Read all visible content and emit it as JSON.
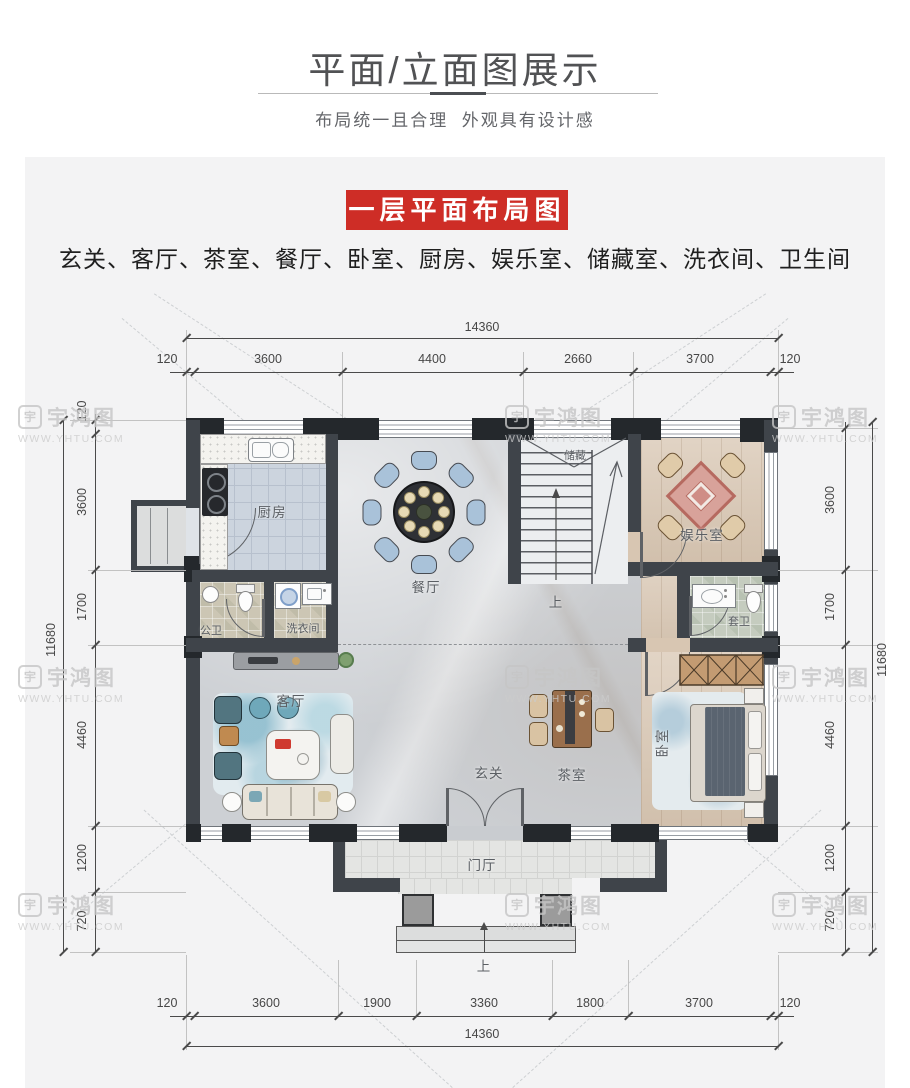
{
  "header": {
    "title": "平面/立面图展示",
    "subtitle": "布局统一且合理  外观具有设计感"
  },
  "section": {
    "badge": "一层平面布局图",
    "room_list": "玄关、客厅、茶室、餐厅、卧室、厨房、娱乐室、储藏室、洗衣间、卫生间"
  },
  "plan": {
    "rooms": {
      "kitchen": "厨房",
      "dining": "餐厅",
      "storage": "储藏",
      "stairs_up": "上",
      "entertainment": "娱乐室",
      "public_bath": "公卫",
      "laundry": "洗衣间",
      "ensuite": "套卫",
      "living": "客厅",
      "foyer": "玄关",
      "tea": "茶室",
      "bedroom": "卧室",
      "porch": "门厅",
      "entry_up": "上"
    },
    "dims": {
      "top_total": "14360",
      "top_segments": [
        "120",
        "3600",
        "4400",
        "2660",
        "3700",
        "120"
      ],
      "bottom_segments": [
        "120",
        "3600",
        "1900",
        "3360",
        "1800",
        "3700",
        "120"
      ],
      "bottom_total": "14360",
      "left_total": "11680",
      "left_segments": [
        "120",
        "3600",
        "1700",
        "4460",
        "1200",
        "720"
      ],
      "right_total": "11680",
      "right_segments": [
        "3600",
        "1700",
        "4460",
        "1200",
        "720"
      ]
    },
    "colors": {
      "wall": "#3f444a",
      "accent_red": "#ce2d26",
      "kitchen_floor": "#ccd4de",
      "wood_floor": "#d8c6b2",
      "marble_floor": "#cdd0d4",
      "dining_chair": "#a9c2d9"
    }
  },
  "watermark": {
    "logo_char": "宇",
    "name": "宇鸿图",
    "url": "WWW.YHTU.COM"
  }
}
